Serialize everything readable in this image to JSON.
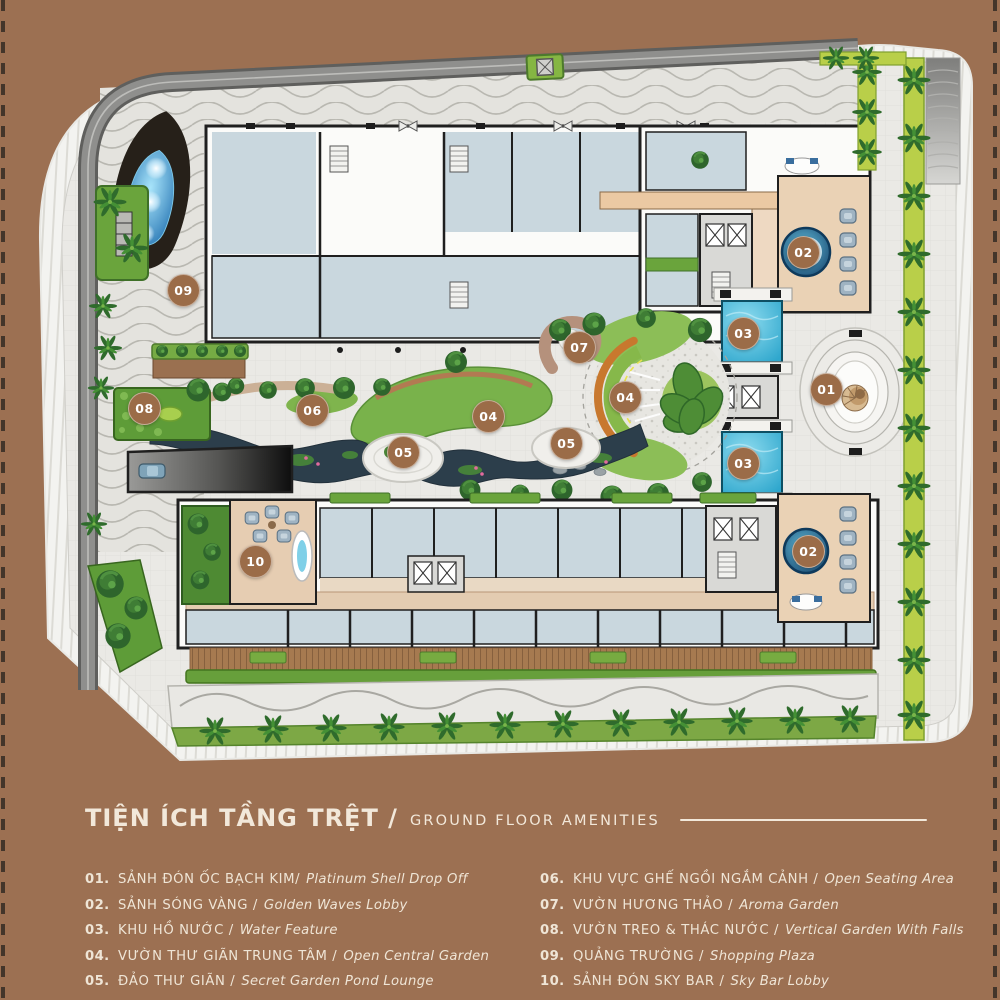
{
  "colors": {
    "background": "#9C7052",
    "text_cream": "#F2E8DA",
    "marker_brown": "#9B6C48",
    "pool_blue": "#3CB9D9",
    "pond_navy": "#2C3E4B",
    "garden_green": "#79B24B",
    "accent_orange": "#C8782E"
  },
  "plan": {
    "markers": [
      {
        "label": "09",
        "x": 183,
        "y": 290
      },
      {
        "label": "08",
        "x": 144,
        "y": 408
      },
      {
        "label": "06",
        "x": 312,
        "y": 410
      },
      {
        "label": "05",
        "x": 403,
        "y": 452
      },
      {
        "label": "04",
        "x": 488,
        "y": 416
      },
      {
        "label": "05",
        "x": 566,
        "y": 443
      },
      {
        "label": "07",
        "x": 579,
        "y": 347
      },
      {
        "label": "04",
        "x": 625,
        "y": 397
      },
      {
        "label": "03",
        "x": 743,
        "y": 333
      },
      {
        "label": "03",
        "x": 743,
        "y": 463
      },
      {
        "label": "01",
        "x": 826,
        "y": 389
      },
      {
        "label": "02",
        "x": 803,
        "y": 252
      },
      {
        "label": "02",
        "x": 808,
        "y": 551
      },
      {
        "label": "10",
        "x": 255,
        "y": 561
      }
    ]
  },
  "legend": {
    "title_vi": "TIỆN ÍCH TẦNG TRỆT /",
    "title_en": "GROUND FLOOR AMENITIES",
    "columns": [
      [
        {
          "num": "01.",
          "vi": "SẢNH ĐÓN ỐC BẠCH KIM/",
          "en": "Platinum Shell Drop Off"
        },
        {
          "num": "02.",
          "vi": "SẢNH SÓNG VÀNG /",
          "en": "Golden Waves Lobby"
        },
        {
          "num": "03.",
          "vi": "KHU HỒ NƯỚC /",
          "en": "Water Feature"
        },
        {
          "num": "04.",
          "vi": "VƯỜN THƯ GIÃN TRUNG TÂM /",
          "en": "Open Central Garden"
        },
        {
          "num": "05.",
          "vi": "ĐẢO THƯ GIÃN /",
          "en": "Secret Garden Pond Lounge"
        }
      ],
      [
        {
          "num": "06.",
          "vi": "KHU VỰC GHẾ NGỒI NGẮM CẢNH /",
          "en": "Open Seating Area"
        },
        {
          "num": "07.",
          "vi": "VƯỜN HƯƠNG THẢO /",
          "en": "Aroma Garden"
        },
        {
          "num": "08.",
          "vi": "VƯỜN TREO & THÁC NƯỚC  /",
          "en": "Vertical Garden With Falls"
        },
        {
          "num": "09.",
          "vi": "QUẢNG TRƯỜNG  /",
          "en": "Shopping Plaza"
        },
        {
          "num": "10.",
          "vi": "SẢNH ĐÓN SKY BAR /",
          "en": "Sky Bar Lobby"
        }
      ]
    ]
  }
}
